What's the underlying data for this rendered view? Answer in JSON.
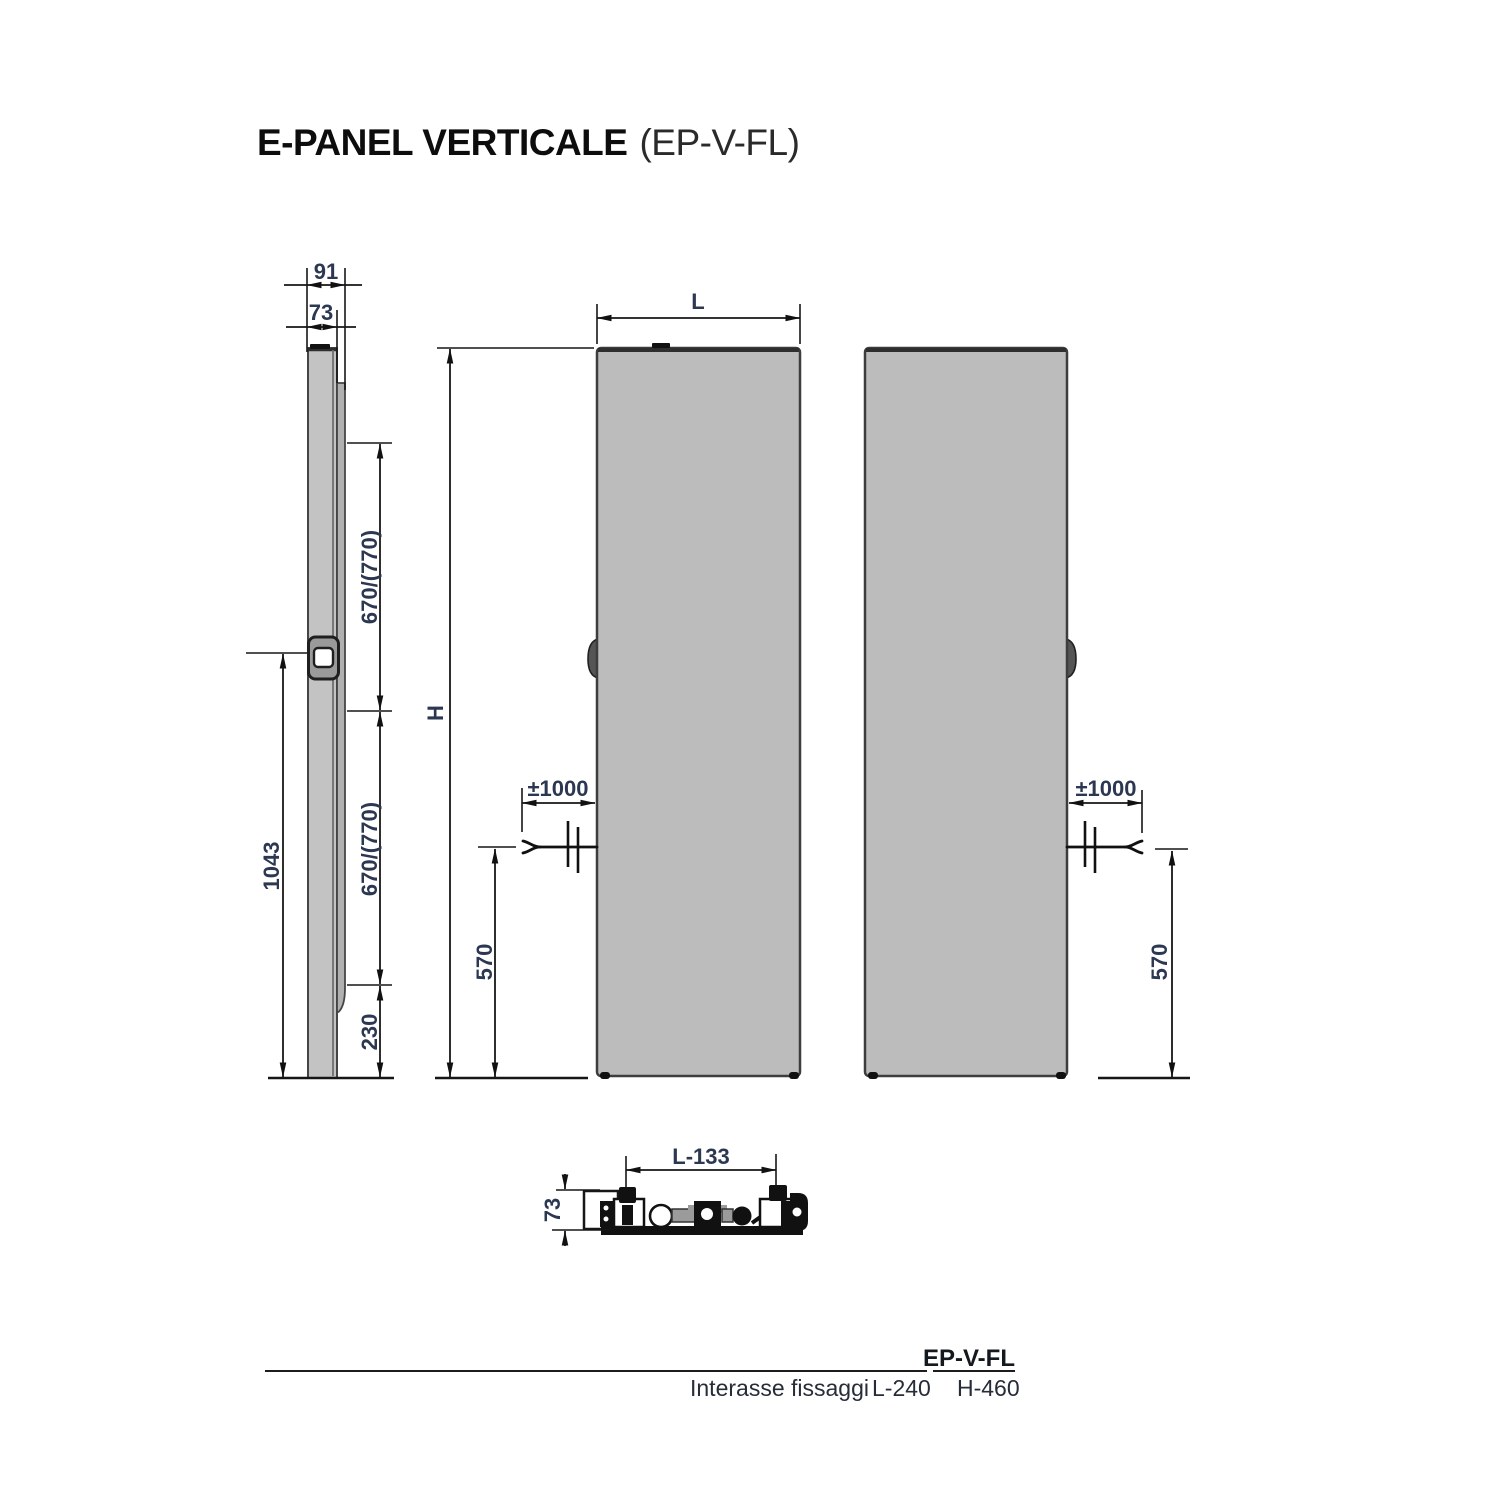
{
  "title": {
    "main": "E-PANEL VERTICALE",
    "code": "(EP-V-FL)"
  },
  "colors": {
    "panel_fill": "#bcbcbc",
    "panel_stroke": "#3f3f3f",
    "line": "#161616",
    "dim_text": "#2c3852"
  },
  "side_view": {
    "total_depth": "91",
    "front_depth": "73",
    "upper_span": "670/(770)",
    "lower_span": "670/(770)",
    "bracket_height": "1043",
    "rear_bottom_gap": "230"
  },
  "front_view": {
    "width_label": "L",
    "height_label": "H",
    "cable_length": "±1000",
    "cable_height": "570"
  },
  "rear_view": {
    "cable_length": "±1000",
    "cable_height": "570"
  },
  "top_view": {
    "fixing_span": "L-133",
    "depth": "73"
  },
  "spec_table": {
    "model": "EP-V-FL",
    "row_label": "Interasse fissaggi",
    "l_spacing": "L-240",
    "h_spacing": "H-460"
  }
}
